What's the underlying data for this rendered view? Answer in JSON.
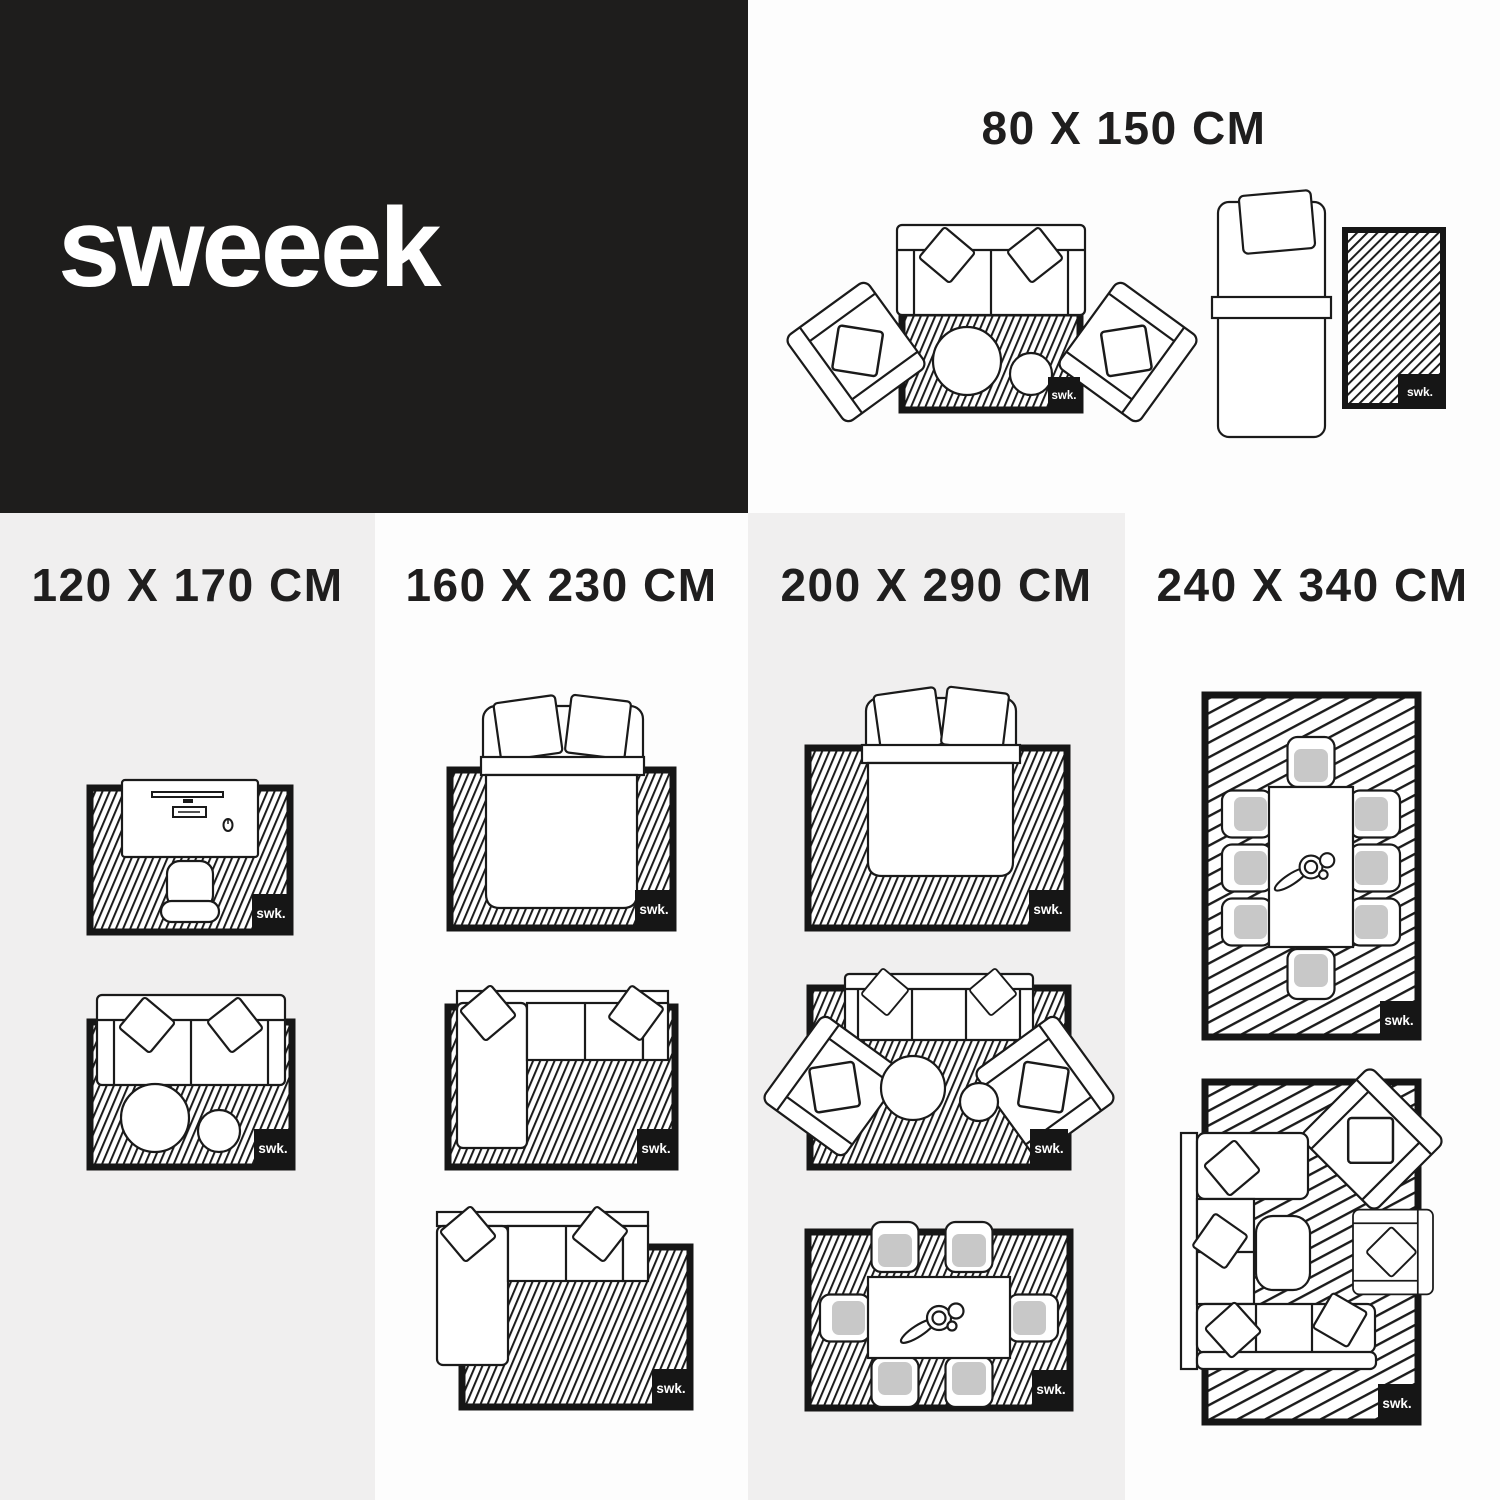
{
  "brand": {
    "logo": "sweeek"
  },
  "rug_tag": "swk.",
  "sections": [
    {
      "id": "80x150",
      "label": "80 X 150 CM",
      "diagrams": [
        "two-seat-sofa-with-armchairs-and-round-tables",
        "single-bed-with-runner-rug"
      ]
    },
    {
      "id": "120x170",
      "label": "120 X 170 CM",
      "diagrams": [
        "desk-with-office-chair",
        "two-seat-sofa-with-round-tables"
      ]
    },
    {
      "id": "160x230",
      "label": "160 X 230 CM",
      "diagrams": [
        "double-bed",
        "corner-sofa-fully-on-rug",
        "corner-sofa-offset-on-rug"
      ]
    },
    {
      "id": "200x290",
      "label": "200 X 290 CM",
      "diagrams": [
        "double-bed",
        "three-seat-sofa-with-armchairs-and-round-tables",
        "dining-table-with-six-chairs"
      ]
    },
    {
      "id": "240x340",
      "label": "240 X 340 CM",
      "diagrams": [
        "dining-table-with-eight-chairs",
        "large-corner-sofa-with-armchairs-and-coffee-table"
      ]
    }
  ],
  "colors": {
    "panel_black": "#1e1d1c",
    "column_gray": "#f0efef",
    "column_white": "#fdfdfd",
    "line_ink": "#1a1a1a",
    "cushion_gray": "#c8c8c8"
  }
}
